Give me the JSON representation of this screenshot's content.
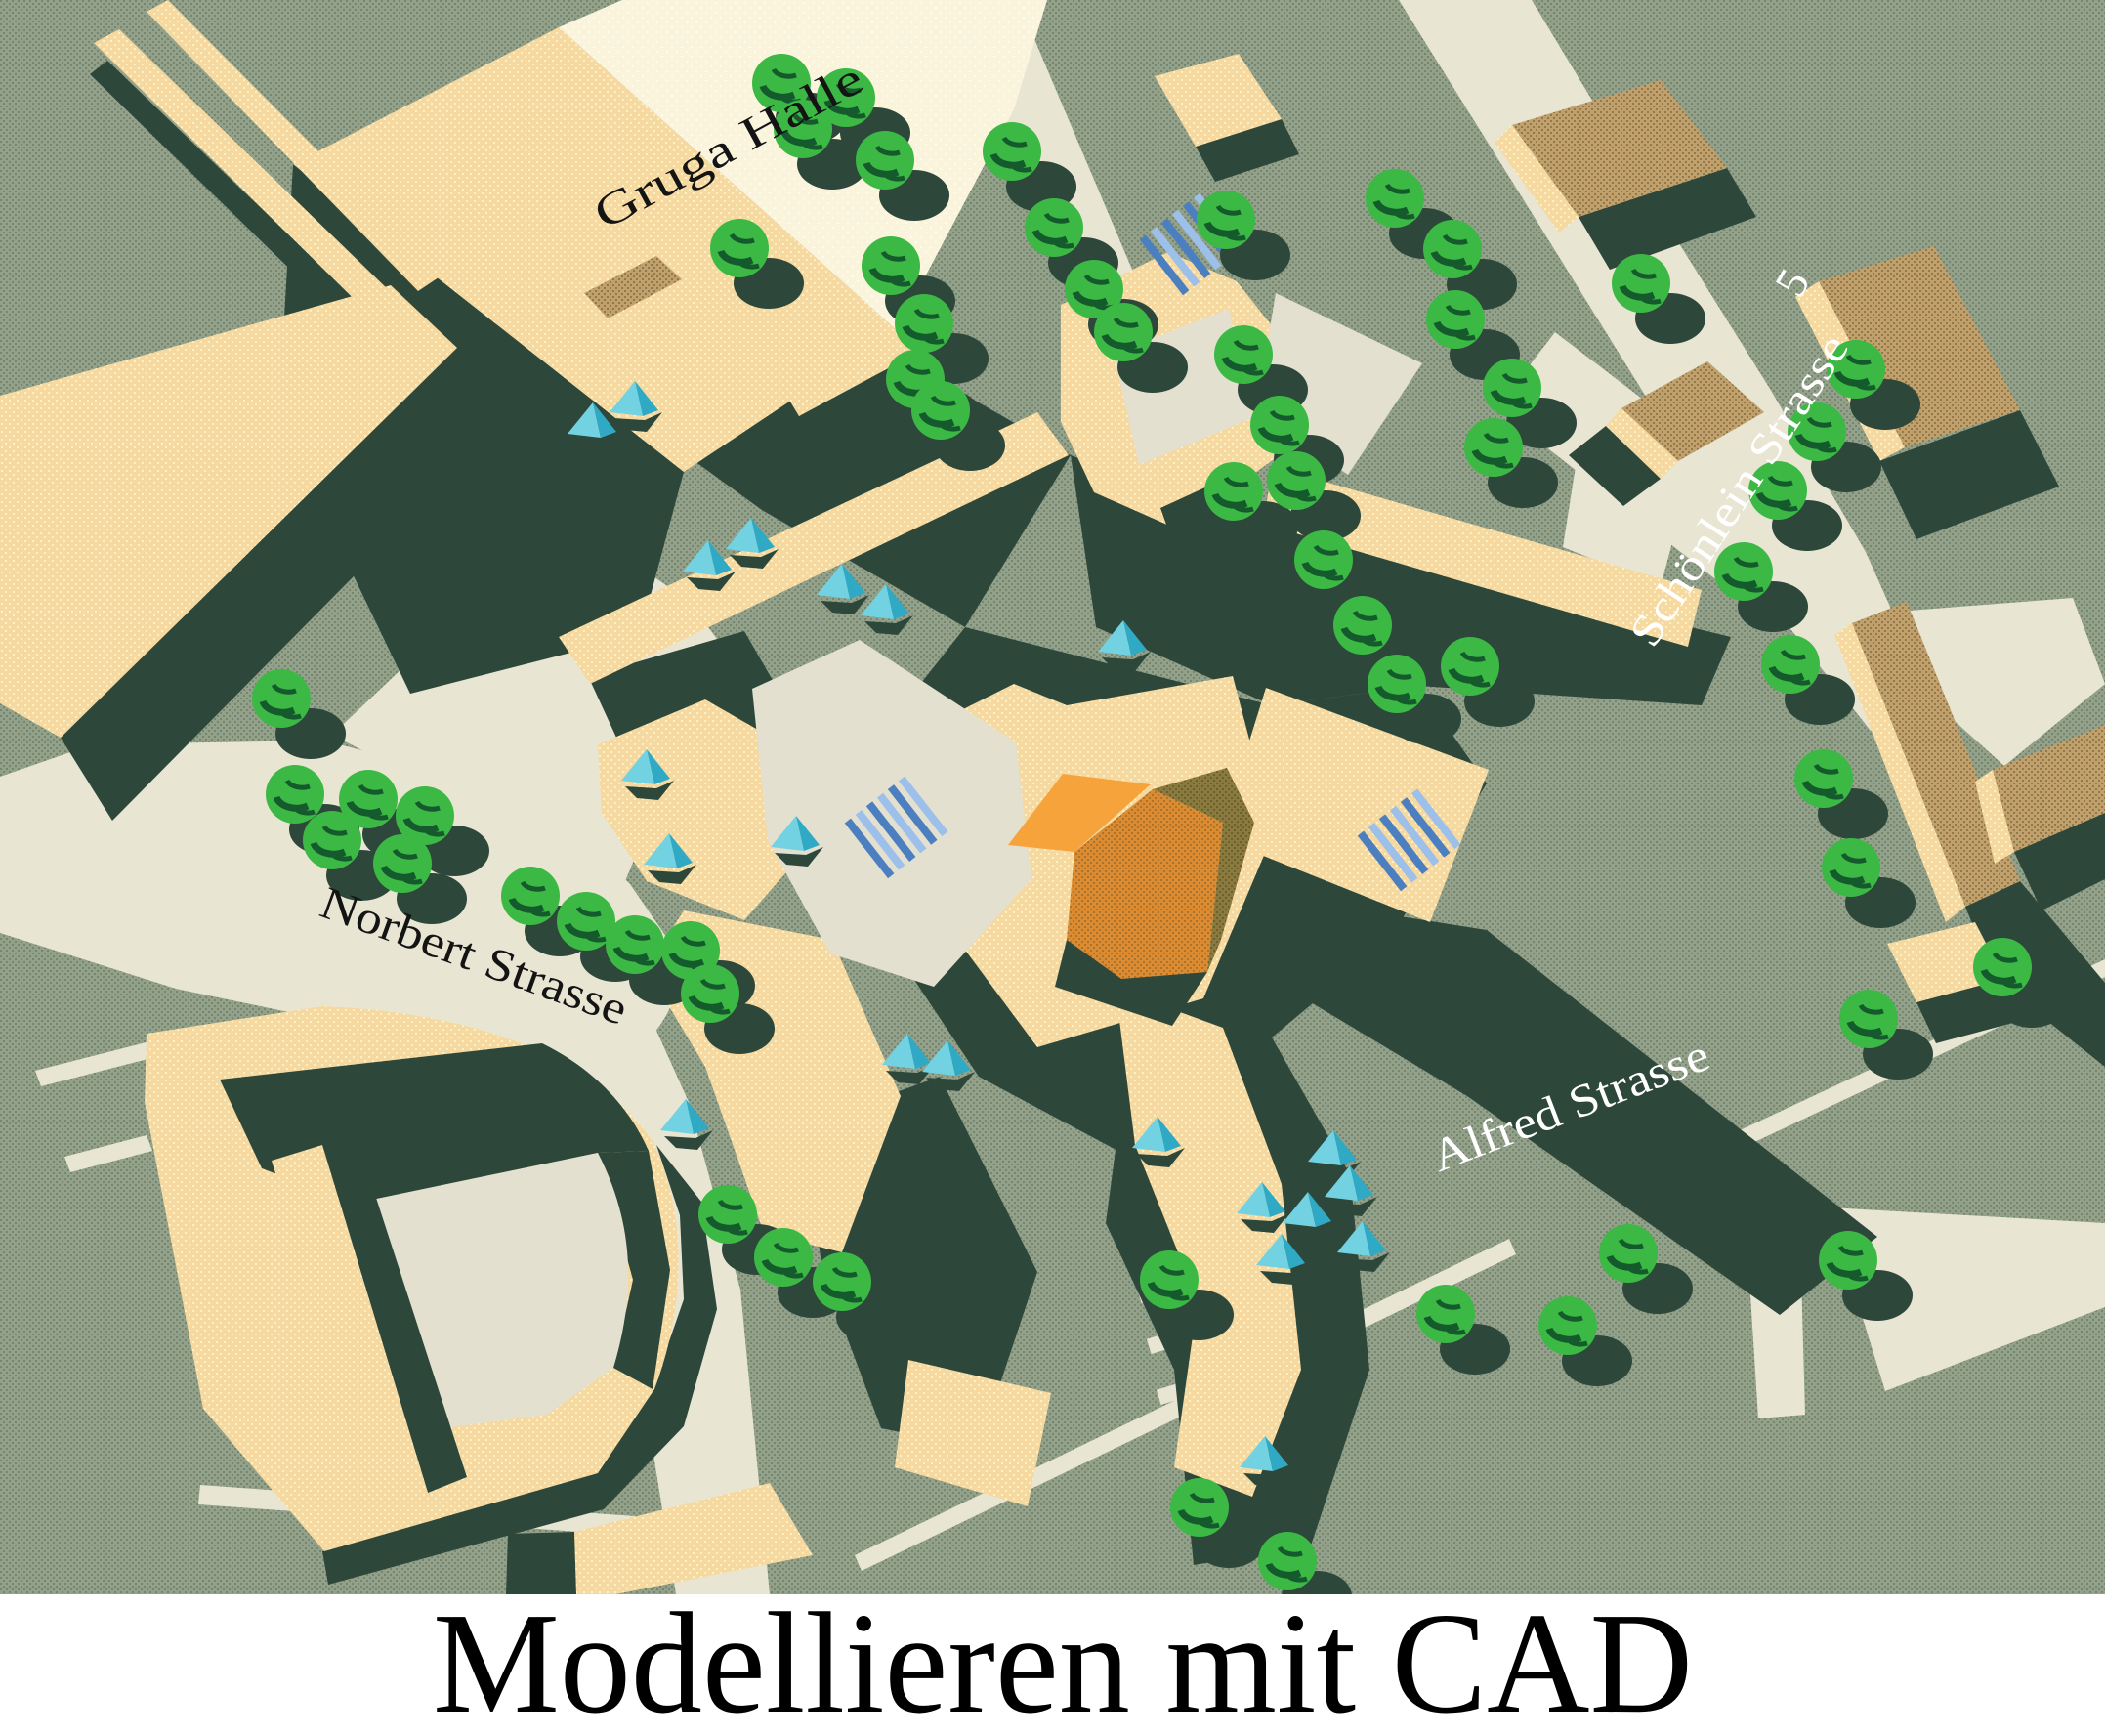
{
  "caption": {
    "text": "Modellieren mit CAD"
  },
  "labels": {
    "gruga_halle": {
      "text": "Gruga Halle"
    },
    "norbert_strasse": {
      "text": "Norbert Strasse"
    },
    "alfred_strasse": {
      "text": "Alfred Strasse"
    },
    "schoenlein_strasse": {
      "text": "Schönlein Strasse"
    },
    "house_number": {
      "text": "5"
    }
  },
  "palette": {
    "grass": "#93a08a",
    "grass_dot": "#75866e",
    "street": "#e9e5d3",
    "courtyard": "#e3e0d0",
    "shadow": "#2d473b",
    "cream": "#f6d9a0",
    "cream_dot": "#fdf0c2",
    "roof_white": "#fbf4dc",
    "roof_dot": "#fffbe9",
    "tan": "#c2a06b",
    "tan_dot": "#8e7a4c",
    "tree": "#3cb944",
    "tree_dark": "#155a2c",
    "cyan": "#2fa9c4",
    "cyan_light": "#72d2e2",
    "sky_blue_dark": "#4c7fc0",
    "sky_blue_light": "#9dc0ea",
    "orange_bright": "#f7a33c",
    "orange": "#dd8b30",
    "orange_dot": "#a8742e",
    "olive": "#8a7a3e",
    "olive_dot": "#6b6030",
    "label_black": "#141414",
    "label_white": "#ffffff",
    "caption_text": "#000000",
    "caption_bg": "#ffffff"
  },
  "scene": {
    "trees": [
      [
        800,
        85
      ],
      [
        866,
        100
      ],
      [
        822,
        132
      ],
      [
        906,
        164
      ],
      [
        757,
        254
      ],
      [
        912,
        272
      ],
      [
        946,
        331
      ],
      [
        937,
        388
      ],
      [
        963,
        420
      ],
      [
        1036,
        155
      ],
      [
        1079,
        233
      ],
      [
        1120,
        296
      ],
      [
        1150,
        340
      ],
      [
        1255,
        225
      ],
      [
        1273,
        363
      ],
      [
        1310,
        435
      ],
      [
        1263,
        503
      ],
      [
        1327,
        492
      ],
      [
        1355,
        573
      ],
      [
        1395,
        640
      ],
      [
        1430,
        700
      ],
      [
        1428,
        203
      ],
      [
        1487,
        255
      ],
      [
        1490,
        327
      ],
      [
        1548,
        397
      ],
      [
        1529,
        458
      ],
      [
        1680,
        290
      ],
      [
        1900,
        378
      ],
      [
        1860,
        442
      ],
      [
        1820,
        502
      ],
      [
        1785,
        585
      ],
      [
        1833,
        680
      ],
      [
        1867,
        797
      ],
      [
        1895,
        888
      ],
      [
        1913,
        1043
      ],
      [
        2050,
        990
      ],
      [
        1667,
        1283
      ],
      [
        1892,
        1290
      ],
      [
        1605,
        1357
      ],
      [
        288,
        715
      ],
      [
        302,
        813
      ],
      [
        340,
        860
      ],
      [
        377,
        818
      ],
      [
        435,
        835
      ],
      [
        412,
        884
      ],
      [
        543,
        917
      ],
      [
        600,
        943
      ],
      [
        650,
        967
      ],
      [
        707,
        973
      ],
      [
        727,
        1017
      ],
      [
        745,
        1243
      ],
      [
        802,
        1287
      ],
      [
        862,
        1312
      ],
      [
        1197,
        1310
      ],
      [
        1480,
        1345
      ],
      [
        1228,
        1543
      ],
      [
        1318,
        1598
      ],
      [
        1505,
        682
      ]
    ],
    "pyramids": [
      [
        723,
        573
      ],
      [
        767,
        550
      ],
      [
        860,
        597
      ],
      [
        905,
        618
      ],
      [
        605,
        432
      ],
      [
        648,
        410
      ],
      [
        660,
        787
      ],
      [
        683,
        873
      ],
      [
        813,
        855
      ],
      [
        927,
        1078
      ],
      [
        968,
        1085
      ],
      [
        1148,
        655
      ],
      [
        1183,
        1163
      ],
      [
        1363,
        1177
      ],
      [
        1380,
        1213
      ],
      [
        1290,
        1230
      ],
      [
        1337,
        1240
      ],
      [
        1310,
        1283
      ],
      [
        1393,
        1270
      ],
      [
        1293,
        1490
      ],
      [
        700,
        1145
      ]
    ],
    "skylights": [
      [
        1222,
        248,
        -38
      ],
      [
        920,
        845,
        -38
      ],
      [
        1445,
        858,
        -38
      ]
    ]
  }
}
